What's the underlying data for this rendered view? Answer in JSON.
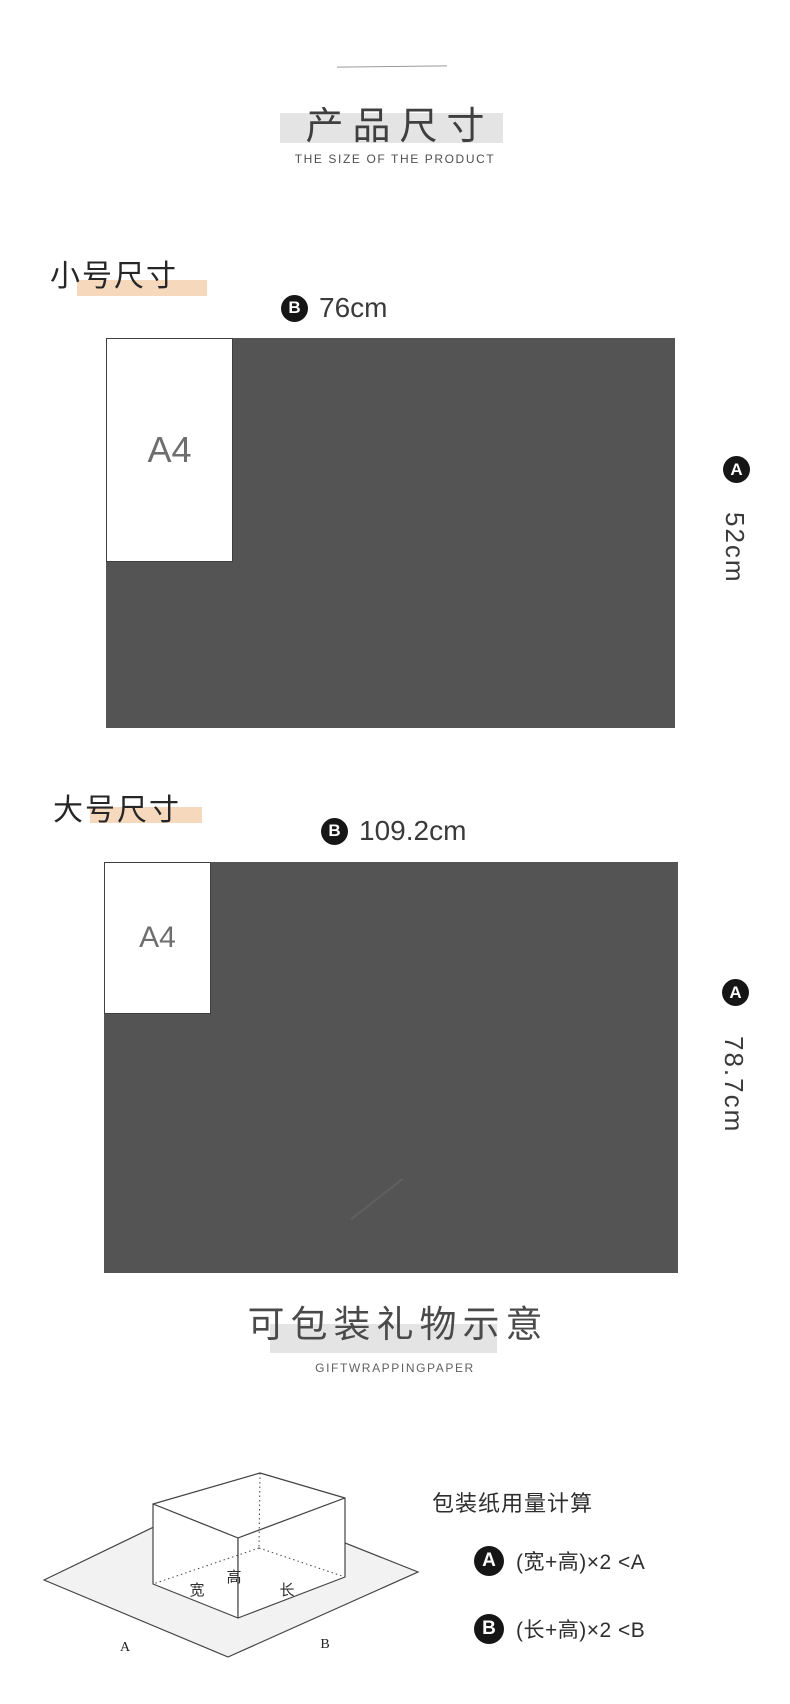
{
  "header": {
    "title": "产品尺寸",
    "subtitle": "THE SIZE OF THE PRODUCT"
  },
  "small": {
    "label": "小号尺寸",
    "width_marker": "B",
    "width_value": "76cm",
    "height_marker": "A",
    "height_value": "52cm",
    "paper_label": "A4"
  },
  "large": {
    "label": "大号尺寸",
    "width_marker": "B",
    "width_value": "109.2cm",
    "height_marker": "A",
    "height_value": "78.7cm",
    "paper_label": "A4"
  },
  "gift": {
    "title": "可包装礼物示意",
    "subtitle": "GIFTWRAPPINGPAPER",
    "calc_title": "包装纸用量计算",
    "formula_a_marker": "A",
    "formula_a": "(宽+高)×2 <A",
    "formula_b_marker": "B",
    "formula_b": "(长+高)×2 <B",
    "box_labels": {
      "width": "宽",
      "height": "高",
      "length": "长",
      "a": "A",
      "b": "B"
    }
  },
  "colors": {
    "paperGray": "#545454",
    "hlGray": "#e4e4e4",
    "hlPeach": "#f6d8bd",
    "markerBlack": "#161616",
    "textDark": "#3c3c3c",
    "sheetFill": "#f2f2f2",
    "lineCol": "#444444"
  }
}
